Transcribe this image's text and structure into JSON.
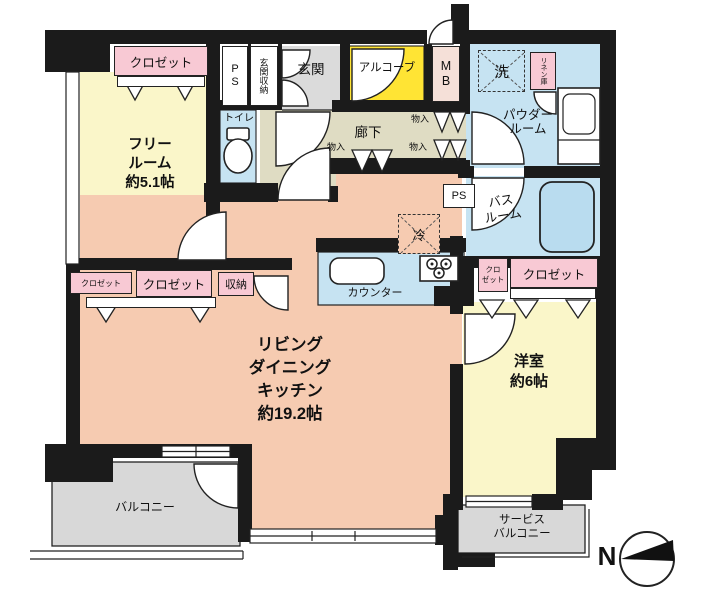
{
  "plan": {
    "rooms": {
      "free_room": [
        "フリー",
        "ルーム",
        "約5.1帖"
      ],
      "ldk": [
        "リビング",
        "ダイニング",
        "キッチン",
        "約19.2帖"
      ],
      "western_room": [
        "洋室",
        "約6帖"
      ],
      "powder_room": [
        "パウダー",
        "ルーム"
      ],
      "bath_room": [
        "バス",
        "ルーム"
      ],
      "service_balcony": [
        "サービス",
        "バルコニー"
      ],
      "balcony": "バルコニー",
      "corridor": "廊下",
      "entrance": "玄関",
      "entrance_storage": "玄関収納",
      "alcove": "アルコーブ",
      "toilet": "トイレ",
      "counter": "カウンター"
    },
    "fixtures": {
      "closet": "クロゼット",
      "closet_two_line": [
        "クロ",
        "ゼット"
      ],
      "storage": "収納",
      "storage_small": "物入",
      "pipe_space": "PS",
      "meter_box": "MB",
      "washer": "洗",
      "linen": "リネン庫",
      "refrigerator": "冷"
    },
    "compass": {
      "north": "N"
    },
    "colors": {
      "wall": "#1b1b1b",
      "yellow": "#FAF6C9",
      "alcove": "#FFE434",
      "salmon": "#F6CBB1",
      "pink": "#F8C9D4",
      "blue": "#C6E3F2",
      "tub": "#B9DCEF",
      "beige": "#DFDCC3",
      "gray": "#DBDBDB",
      "bgray": "#D8D8D8",
      "mbpink": "#F5E0D8"
    }
  }
}
